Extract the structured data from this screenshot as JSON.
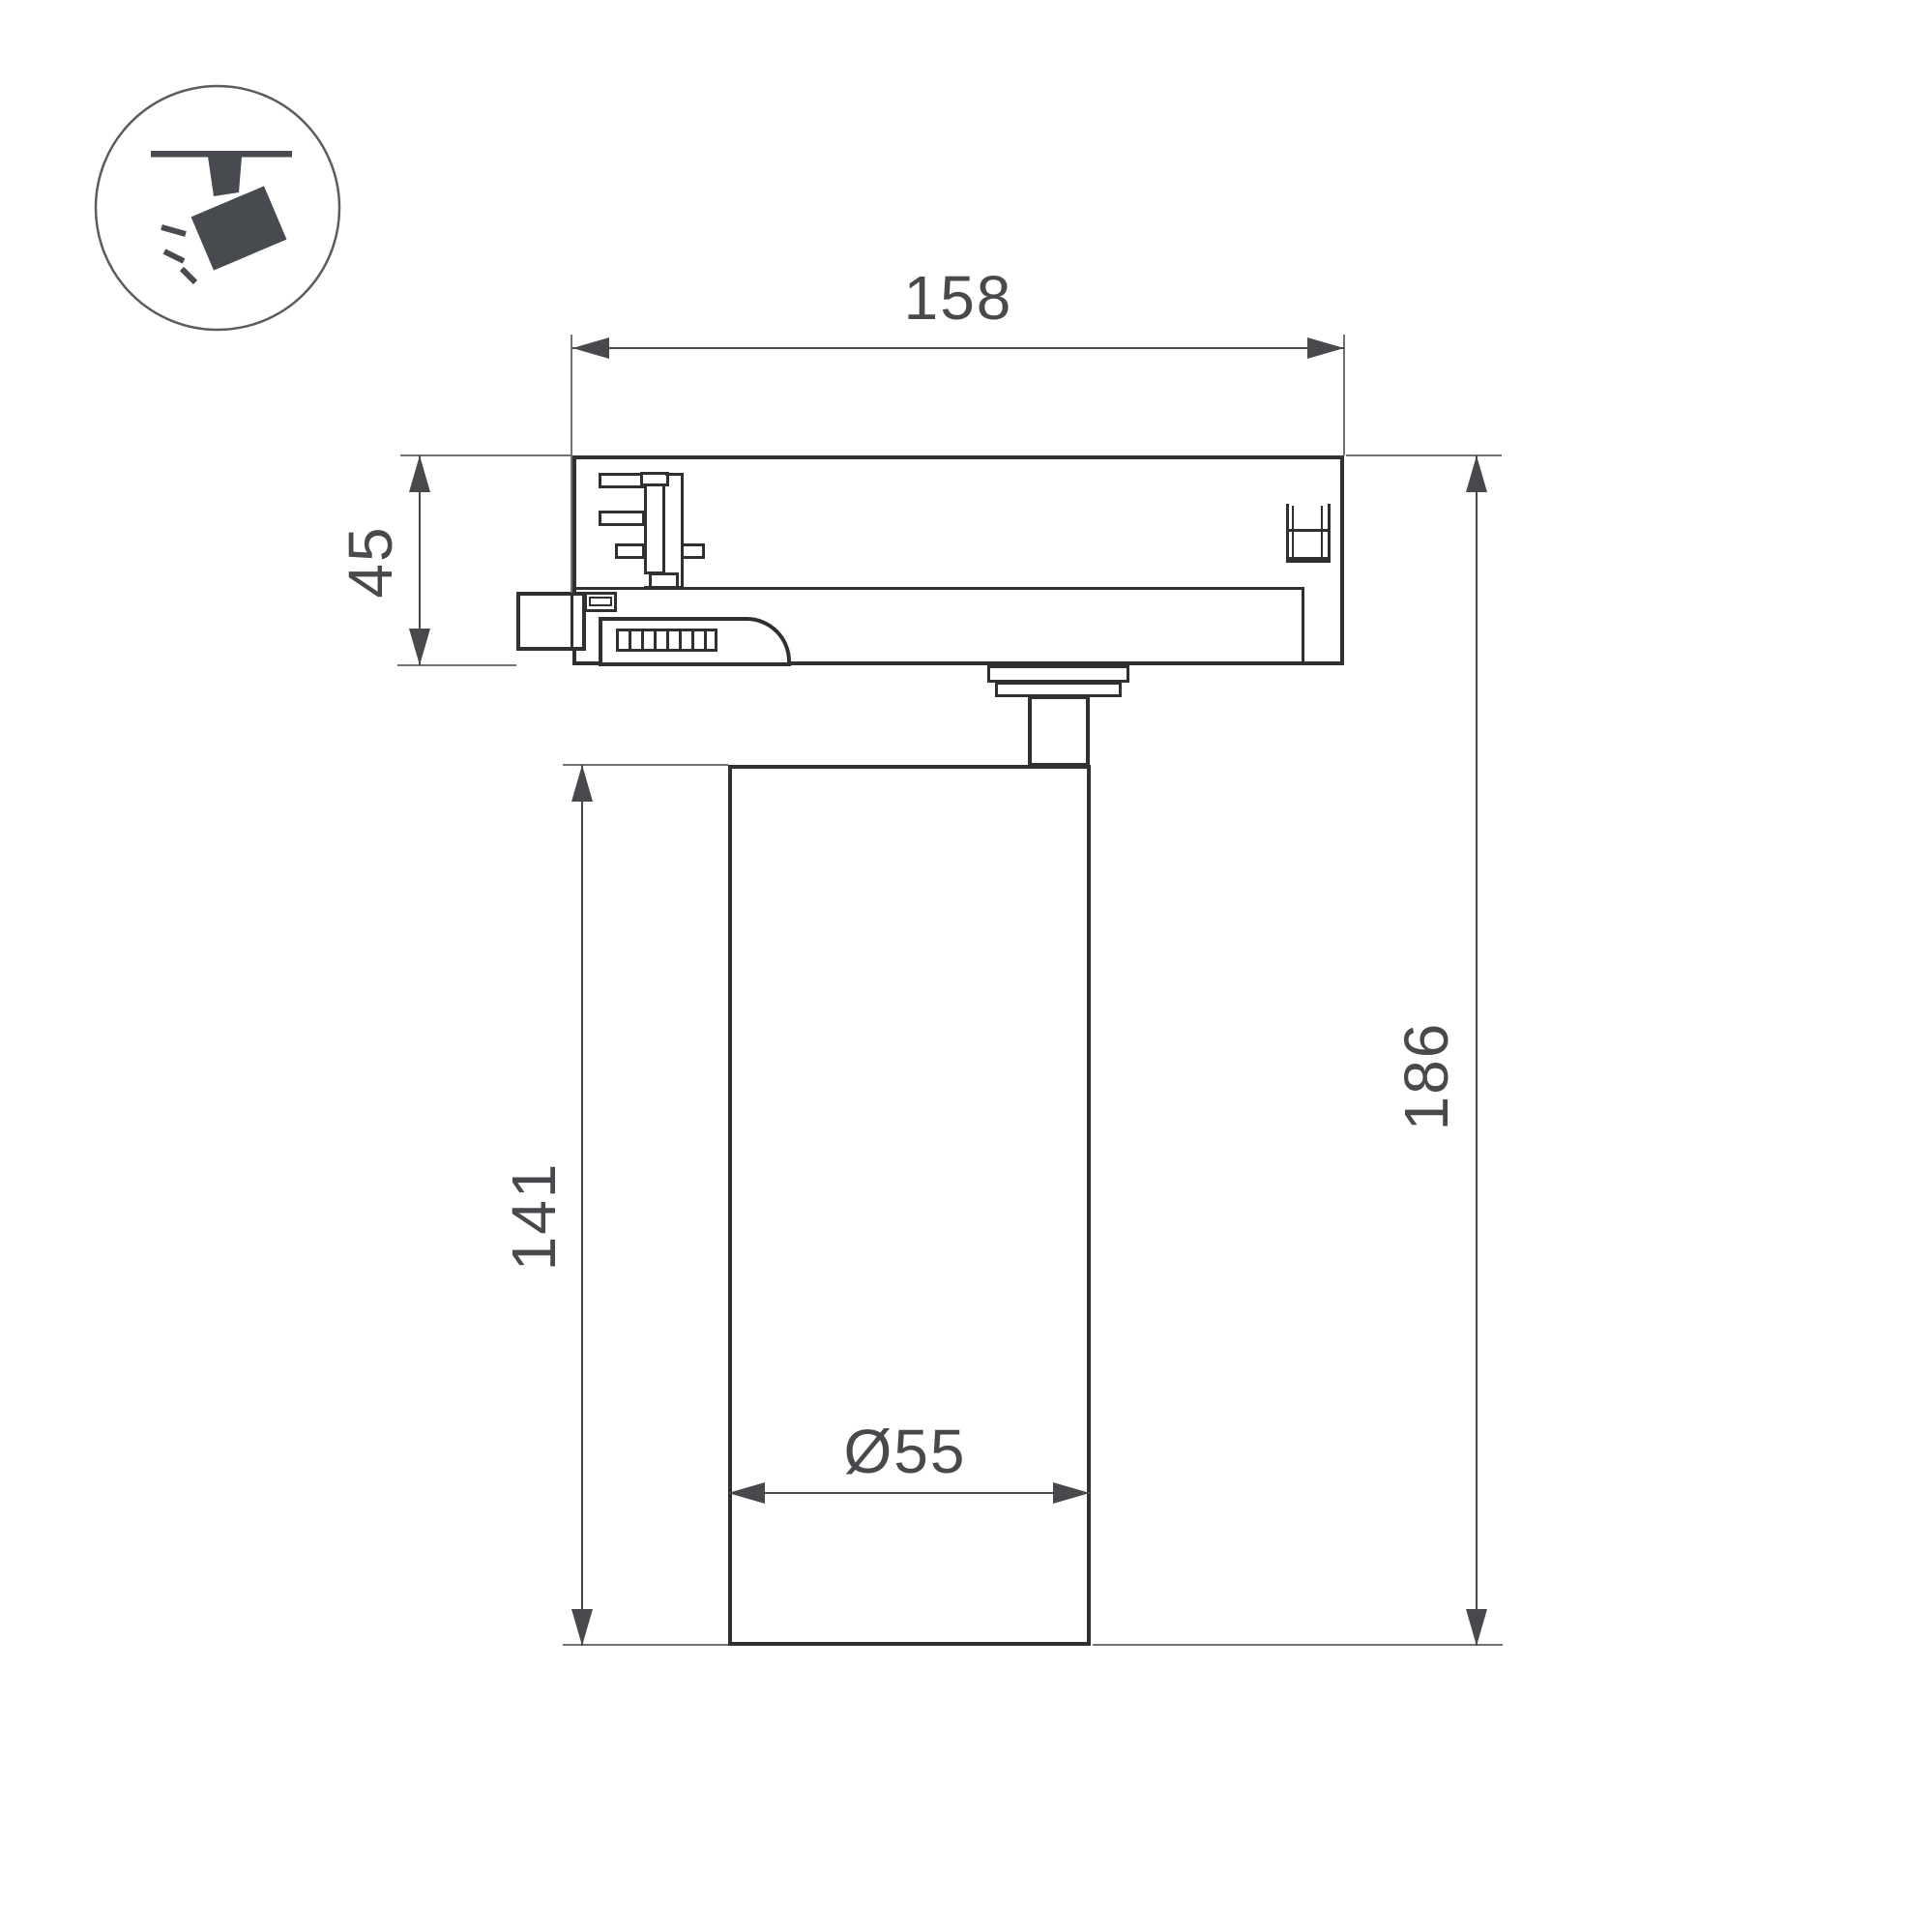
{
  "drawing": {
    "title": "Track spotlight dimension drawing",
    "icon": "ceiling-track-spotlight-icon",
    "dimensions": {
      "adapter_length_mm": "158",
      "adapter_height_mm": "45",
      "body_height_mm": "141",
      "total_height_mm": "186",
      "body_diameter_mm": "Ø55"
    },
    "colors": {
      "outline": "#2e3032",
      "dimension_line": "#47494c",
      "extension_line": "#6f7174",
      "text": "#47494c",
      "icon_fill": "#474b4f",
      "background": "#ffffff"
    }
  }
}
